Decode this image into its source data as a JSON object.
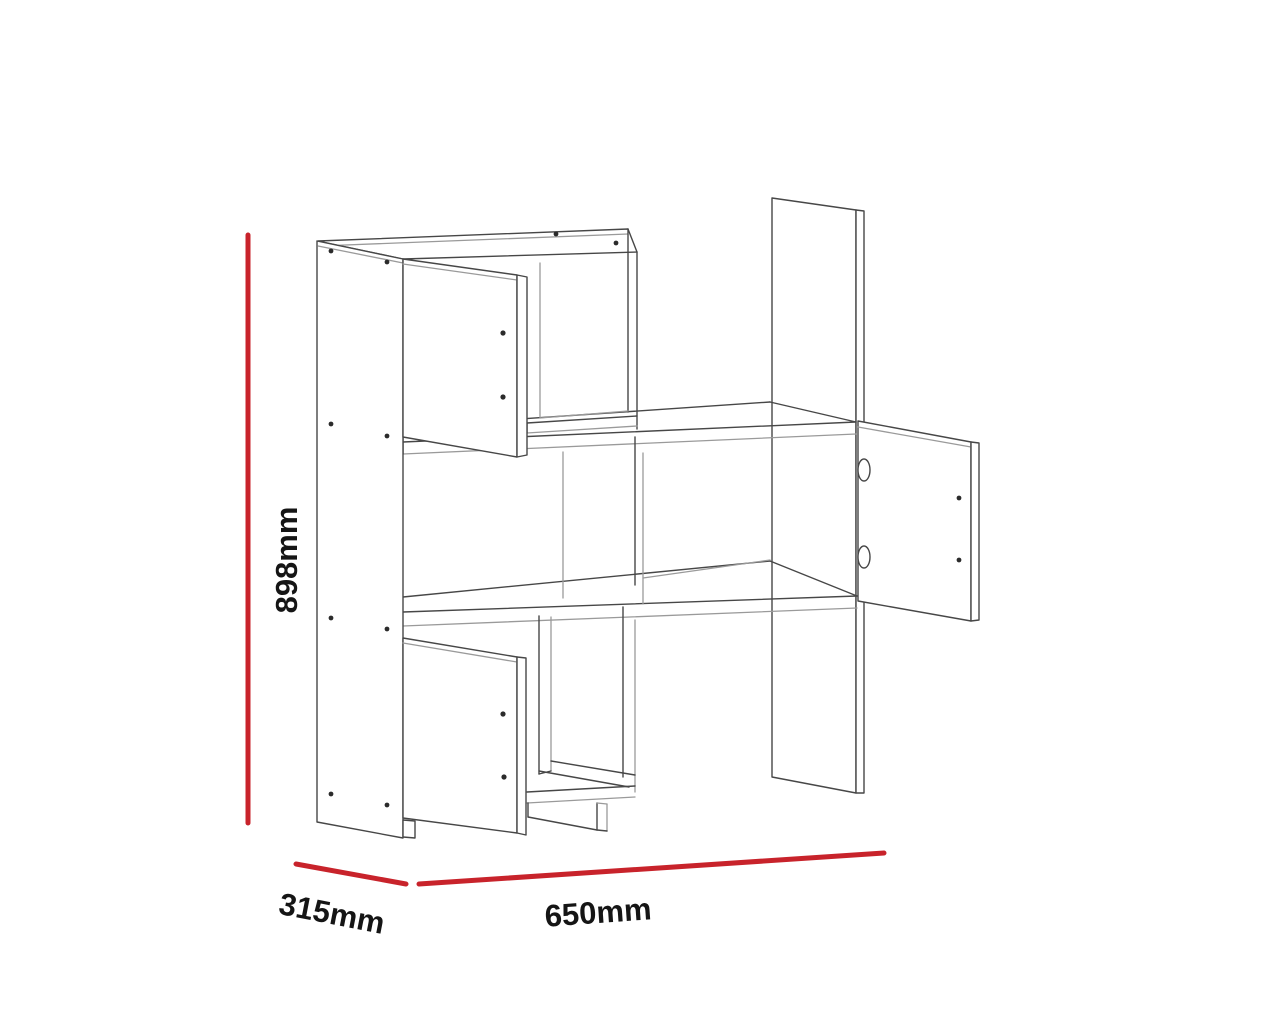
{
  "diagram": {
    "kind": "furniture dimension drawing",
    "object": "wall shelf unit shown as 3D wireframe with open doors",
    "background_color": "#ffffff",
    "drawing_line_color": "#474747",
    "dimension_line_color": "#c8232b",
    "label_text_color": "#151515",
    "dimensions": {
      "height": {
        "label": "898mm",
        "value": 898,
        "unit": "mm",
        "axis": "vertical-left"
      },
      "depth": {
        "label": "315mm",
        "value": 315,
        "unit": "mm",
        "axis": "bottom-left"
      },
      "width": {
        "label": "650mm",
        "value": 650,
        "unit": "mm",
        "axis": "bottom-right"
      }
    }
  }
}
